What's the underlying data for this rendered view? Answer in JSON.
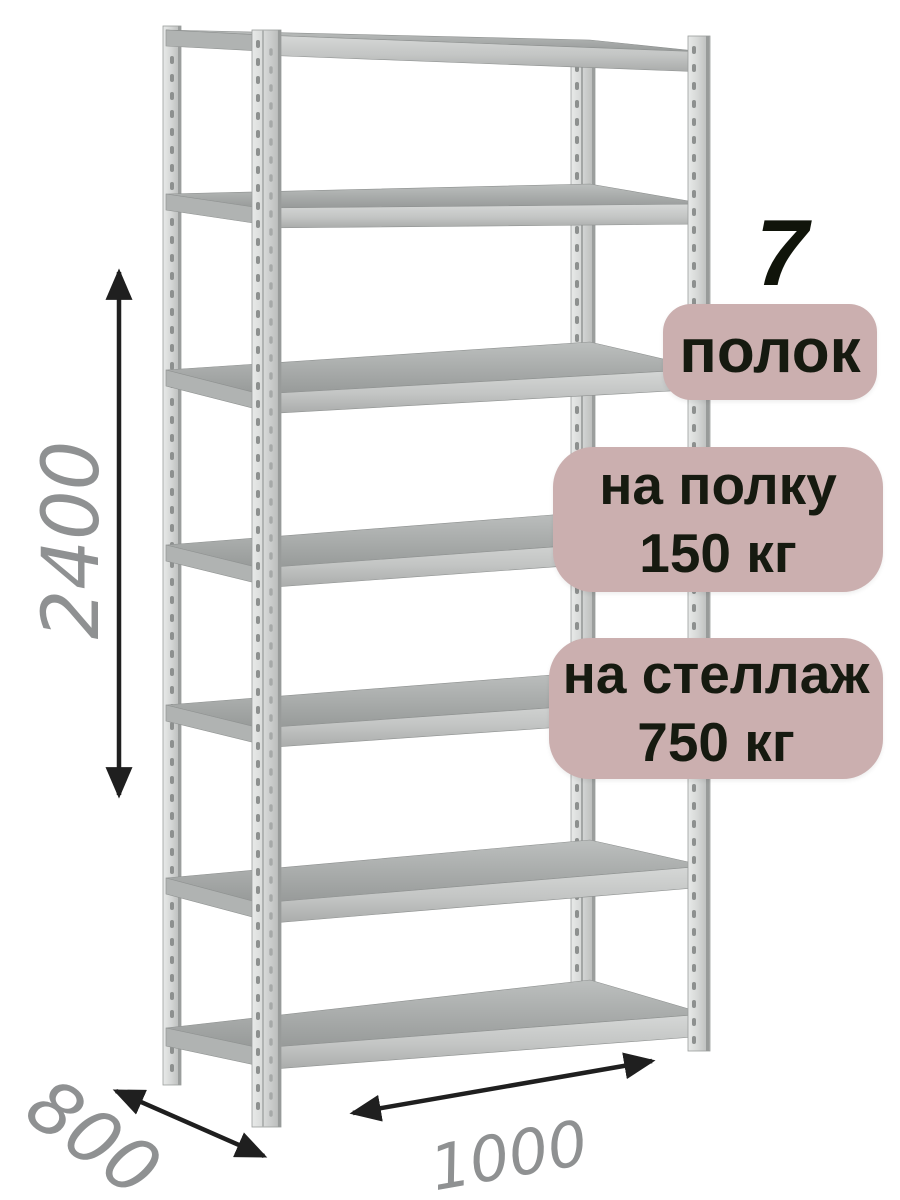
{
  "badges": {
    "shelf_count": {
      "number": "7",
      "label": "полок"
    },
    "shelf_load": {
      "line1": "на полку",
      "line2": "150 кг"
    },
    "rack_load": {
      "line1": "на стеллаж",
      "line2": "750 кг"
    }
  },
  "dimensions": {
    "height_mm": "2400",
    "depth_mm": "800",
    "width_mm": "1000"
  },
  "illustration": {
    "subject": "metal-shelving-rack",
    "shelves_drawn": 7,
    "posts_drawn": 4
  },
  "colors": {
    "background": "#ffffff",
    "badge_bg": "#cbafaf",
    "badge_text": "#161a10",
    "count_number": "#10140a",
    "dimension_text": "#8f9192",
    "arrow": "#1f1f1f",
    "metal_light": "#e2e4e3",
    "metal_mid": "#c3c5c4",
    "metal_shade": "#9a9d9c"
  }
}
